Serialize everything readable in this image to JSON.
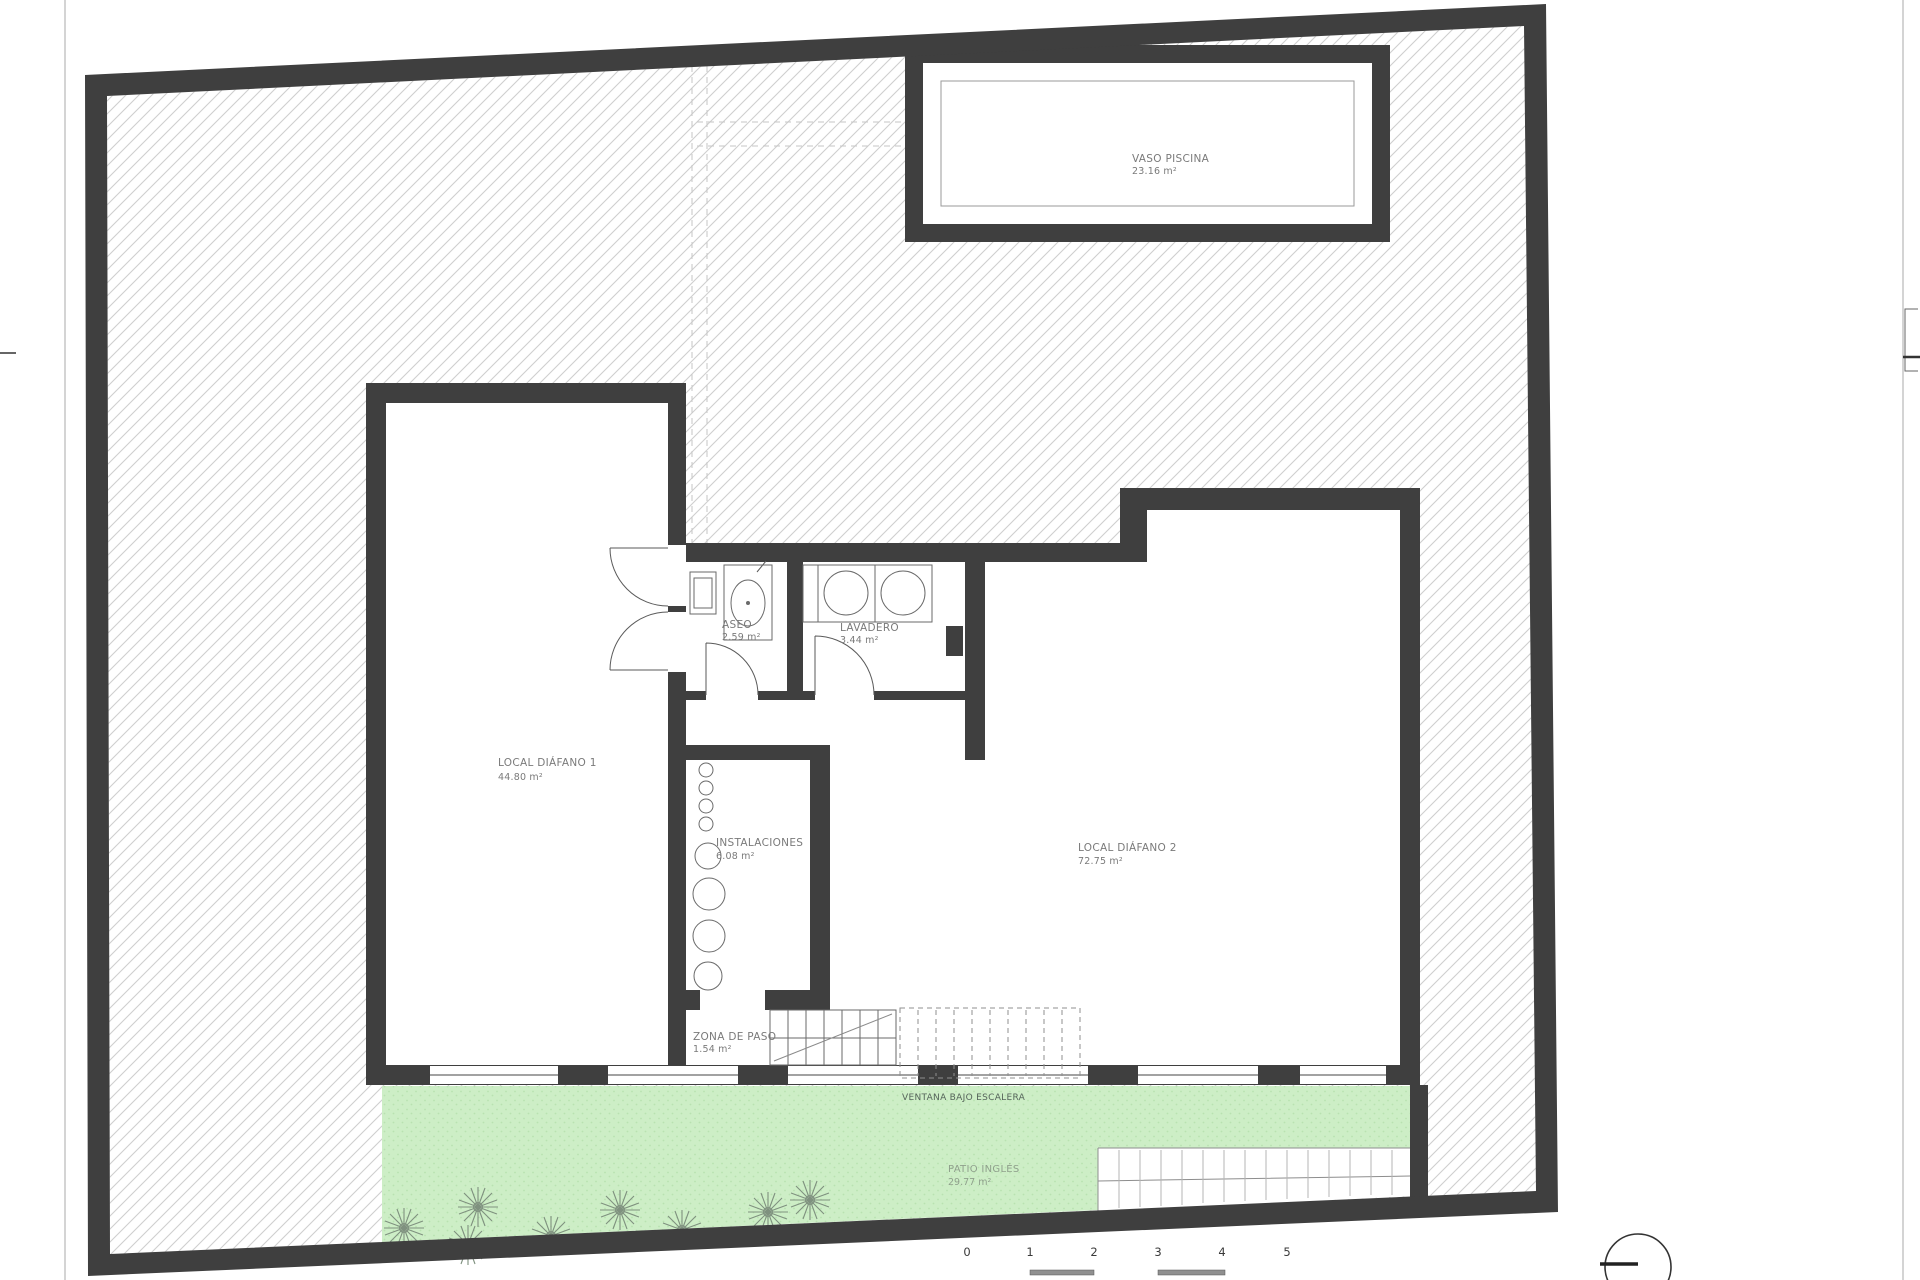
{
  "drawing": {
    "title_hint": "basement floor plan",
    "rooms": {
      "vaso_piscina": {
        "name": "VASO PISCINA",
        "area": "23.16 m²"
      },
      "local_diafano_1": {
        "name": "LOCAL DIÁFANO 1",
        "area": "44.80 m²"
      },
      "local_diafano_2": {
        "name": "LOCAL DIÁFANO 2",
        "area": "72.75 m²"
      },
      "aseo": {
        "name": "ASEO",
        "area": "2.59 m²"
      },
      "lavadero": {
        "name": "LAVADERO",
        "area": "3.44 m²"
      },
      "instalaciones": {
        "name": "INSTALACIONES",
        "area": "6.08 m²"
      },
      "zona_de_paso": {
        "name": "ZONA DE PASO",
        "area": "1.54 m²"
      },
      "patio_ingles": {
        "name": "PATIO INGLÉS",
        "area": "29.77 m²"
      }
    },
    "annotations": {
      "ventana_bajo_escalera": "VENTANA BAJO ESCALERA"
    },
    "scale_bar": {
      "ticks": [
        "0",
        "1",
        "2",
        "3",
        "4",
        "5"
      ]
    },
    "colors": {
      "wall": "#3f3f3f",
      "hatch_line": "#cfcfcf",
      "patio_green": "#cdeec6",
      "label_text": "#7a7a7a"
    }
  }
}
